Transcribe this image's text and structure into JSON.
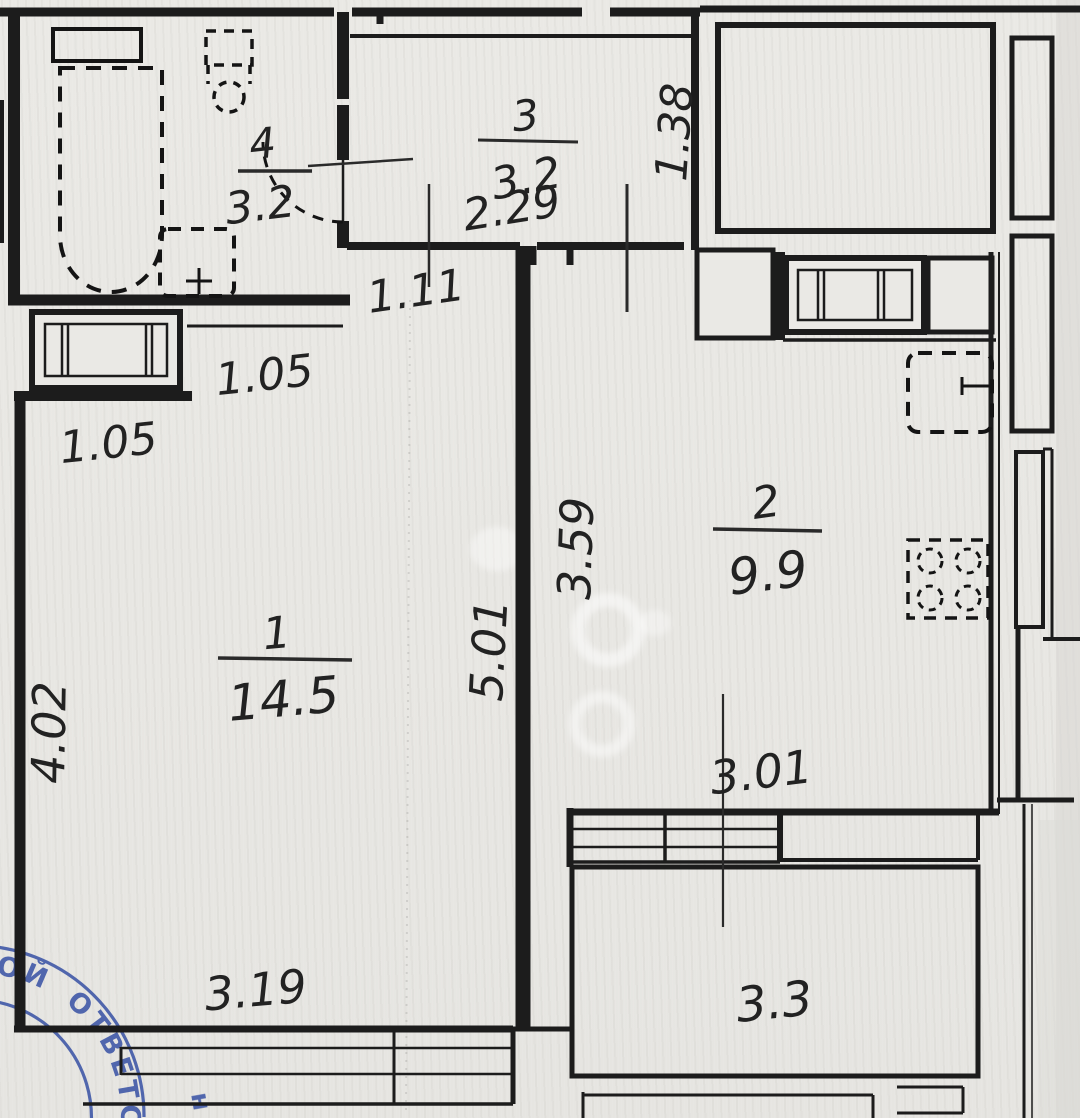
{
  "plan": {
    "colors": {
      "paper": "#e9e8e4",
      "ink": "#1c1c1c",
      "stamp_blue": "#3c55a6"
    },
    "rooms": [
      {
        "number": "1",
        "area": "14.5"
      },
      {
        "number": "2",
        "area": "9.9"
      },
      {
        "number": "3",
        "area": "3.2"
      },
      {
        "number": "4",
        "area": "3.2"
      }
    ],
    "balcony": {
      "area": "3.3"
    },
    "dimensions": {
      "hall_width": "2.29",
      "hall_niche_width": "1.38",
      "passage_width": "1.11",
      "pier_a": "1.05",
      "pier_b": "1.05",
      "kitchen_depth": "3.59",
      "room_depth": "5.01",
      "room_left_depth": "4.02",
      "room_width": "3.19",
      "kitchen_width": "3.01"
    },
    "stamp": {
      "arc_text": "ОЙ ОТВЕТСТВЕН",
      "fragment": "н"
    }
  }
}
